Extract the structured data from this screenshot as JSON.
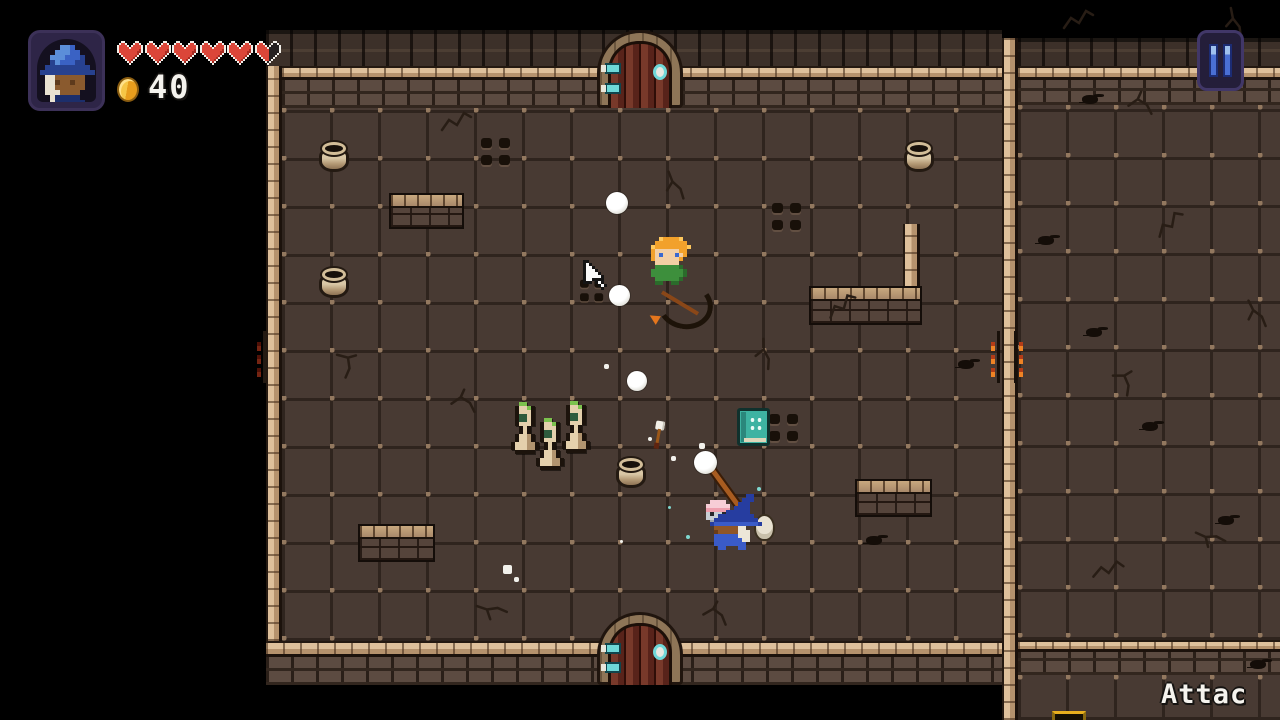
{
  "hud": {
    "portrait_icon": "wizard-portrait",
    "hearts": {
      "total": 6,
      "full": 5,
      "half": 1
    },
    "coin_icon": "coin-icon",
    "coin_count": "40",
    "pause_icon": "pause-icon"
  },
  "action_label": "Attac",
  "colors": {
    "floor": "#483a33",
    "wall_brick": "#5c4b41",
    "ledge_tan": "#dec09b",
    "door_wood": "#6b2f22",
    "accent_teal": "#6fd8d8",
    "heart_red": "#db4639",
    "coin_gold": "#e89d1d",
    "pause_blue": "#4a6fd4",
    "book_teal": "#3eb3a2",
    "statue_tan": "#e4d0ac"
  },
  "layout": {
    "segments": [
      {
        "kind": "wall-top",
        "x": 266,
        "y": 30,
        "w": 736,
        "h": 36
      },
      {
        "kind": "ledge-h",
        "x": 282,
        "y": 66,
        "w": 720,
        "h": 14
      },
      {
        "kind": "wall-face",
        "x": 282,
        "y": 80,
        "w": 720,
        "h": 28
      },
      {
        "kind": "floor",
        "x": 282,
        "y": 108,
        "w": 720,
        "h": 533
      },
      {
        "kind": "ledge-v",
        "x": 266,
        "y": 66,
        "w": 16,
        "h": 575
      },
      {
        "kind": "ledge-h",
        "x": 266,
        "y": 641,
        "w": 736,
        "h": 16
      },
      {
        "kind": "wall-face",
        "x": 266,
        "y": 657,
        "w": 736,
        "h": 28
      },
      {
        "kind": "ledge-v",
        "x": 1002,
        "y": 38,
        "w": 16,
        "h": 682
      },
      {
        "kind": "wall-top",
        "x": 1018,
        "y": 38,
        "w": 262,
        "h": 28
      },
      {
        "kind": "ledge-h",
        "x": 1018,
        "y": 66,
        "w": 262,
        "h": 14
      },
      {
        "kind": "wall-face",
        "x": 1018,
        "y": 80,
        "w": 262,
        "h": 25
      },
      {
        "kind": "floor",
        "x": 1018,
        "y": 105,
        "w": 262,
        "h": 535
      },
      {
        "kind": "ledge-h",
        "x": 1018,
        "y": 640,
        "w": 262,
        "h": 12
      },
      {
        "kind": "wall-face",
        "x": 1018,
        "y": 652,
        "w": 262,
        "h": 23
      },
      {
        "kind": "floor",
        "x": 1018,
        "y": 675,
        "w": 262,
        "h": 45
      },
      {
        "kind": "ledge-v",
        "x": 903,
        "y": 224,
        "w": 17,
        "h": 64
      }
    ],
    "doors": [
      {
        "x": 597,
        "y": 30,
        "w": 86,
        "h": 78
      },
      {
        "x": 597,
        "y": 612,
        "w": 86,
        "h": 73
      }
    ],
    "low_walls": [
      {
        "x": 389,
        "y": 193,
        "w": 75,
        "h": 36
      },
      {
        "x": 809,
        "y": 286,
        "w": 113,
        "h": 39
      },
      {
        "x": 855,
        "y": 479,
        "w": 77,
        "h": 38
      },
      {
        "x": 358,
        "y": 524,
        "w": 77,
        "h": 38
      }
    ]
  },
  "entities": [
    {
      "type": "torch-left",
      "x": 256,
      "y": 331
    },
    {
      "type": "torch-right",
      "x": 991,
      "y": 331
    },
    {
      "type": "pot",
      "x": 317,
      "y": 141
    },
    {
      "type": "pot",
      "x": 902,
      "y": 141
    },
    {
      "type": "pot",
      "x": 317,
      "y": 267
    },
    {
      "type": "pot",
      "x": 614,
      "y": 457
    },
    {
      "type": "grate",
      "x": 481,
      "y": 138
    },
    {
      "type": "grate",
      "x": 772,
      "y": 203
    },
    {
      "type": "grate",
      "x": 769,
      "y": 414
    },
    {
      "type": "grate",
      "x": 577,
      "y": 277,
      "small": true
    },
    {
      "type": "statue",
      "x": 511,
      "y": 402
    },
    {
      "type": "statue",
      "x": 562,
      "y": 401
    },
    {
      "type": "statue",
      "x": 536,
      "y": 418
    },
    {
      "type": "book",
      "x": 737,
      "y": 408
    },
    {
      "type": "arrow",
      "x": 652,
      "y": 421
    },
    {
      "type": "archer",
      "x": 641,
      "y": 237
    },
    {
      "type": "snowball",
      "x": 606,
      "y": 192,
      "s": 22
    },
    {
      "type": "snowball",
      "x": 609,
      "y": 285,
      "s": 21
    },
    {
      "type": "snowball",
      "x": 627,
      "y": 371,
      "s": 20
    },
    {
      "type": "staff",
      "x": 721,
      "y": 452
    },
    {
      "type": "snowball",
      "x": 694,
      "y": 451,
      "s": 23
    },
    {
      "type": "rat",
      "x": 706,
      "y": 500
    },
    {
      "type": "player",
      "x": 710,
      "y": 492
    },
    {
      "type": "chest-top",
      "x": 1052,
      "y": 711
    },
    {
      "type": "cursor",
      "x": 583,
      "y": 257
    }
  ],
  "decor": {
    "cracks": [
      {
        "x": 440,
        "y": 108,
        "r": 0,
        "v": 0
      },
      {
        "x": 662,
        "y": 170,
        "r": 20,
        "v": 1
      },
      {
        "x": 826,
        "y": 292,
        "r": -15,
        "v": 0
      },
      {
        "x": 752,
        "y": 340,
        "r": 40,
        "v": 1
      },
      {
        "x": 448,
        "y": 388,
        "r": 10,
        "v": 2
      },
      {
        "x": 476,
        "y": 592,
        "r": -30,
        "v": 1
      },
      {
        "x": 700,
        "y": 600,
        "r": 15,
        "v": 2
      },
      {
        "x": 330,
        "y": 350,
        "r": 60,
        "v": 2
      },
      {
        "x": 1062,
        "y": 6,
        "r": 0,
        "v": 0
      },
      {
        "x": 1222,
        "y": 8,
        "r": 30,
        "v": 1
      },
      {
        "x": 1154,
        "y": 210,
        "r": -20,
        "v": 0
      },
      {
        "x": 1243,
        "y": 298,
        "r": 15,
        "v": 1
      },
      {
        "x": 1108,
        "y": 368,
        "r": 45,
        "v": 2
      },
      {
        "x": 1125,
        "y": 90,
        "r": 10,
        "v": 2
      },
      {
        "x": 1195,
        "y": 520,
        "r": -25,
        "v": 1
      },
      {
        "x": 1092,
        "y": 556,
        "r": 5,
        "v": 0
      }
    ],
    "debris": [
      {
        "x": 1082,
        "y": 95
      },
      {
        "x": 1038,
        "y": 236
      },
      {
        "x": 1142,
        "y": 422
      },
      {
        "x": 1086,
        "y": 328
      },
      {
        "x": 1218,
        "y": 516
      },
      {
        "x": 866,
        "y": 536
      },
      {
        "x": 958,
        "y": 360
      },
      {
        "x": 1250,
        "y": 660
      }
    ],
    "particles": [
      {
        "x": 604,
        "y": 364,
        "s": 5,
        "c": "white"
      },
      {
        "x": 648,
        "y": 437,
        "s": 4,
        "c": "white"
      },
      {
        "x": 671,
        "y": 456,
        "s": 5,
        "c": "white"
      },
      {
        "x": 699,
        "y": 443,
        "s": 6,
        "c": "white"
      },
      {
        "x": 503,
        "y": 565,
        "s": 9,
        "c": "white"
      },
      {
        "x": 514,
        "y": 577,
        "s": 5,
        "c": "white"
      },
      {
        "x": 686,
        "y": 535,
        "s": 4,
        "c": "teal"
      },
      {
        "x": 668,
        "y": 506,
        "s": 3,
        "c": "teal"
      },
      {
        "x": 757,
        "y": 487,
        "s": 4,
        "c": "teal"
      },
      {
        "x": 620,
        "y": 540,
        "s": 3,
        "c": "white"
      }
    ]
  }
}
